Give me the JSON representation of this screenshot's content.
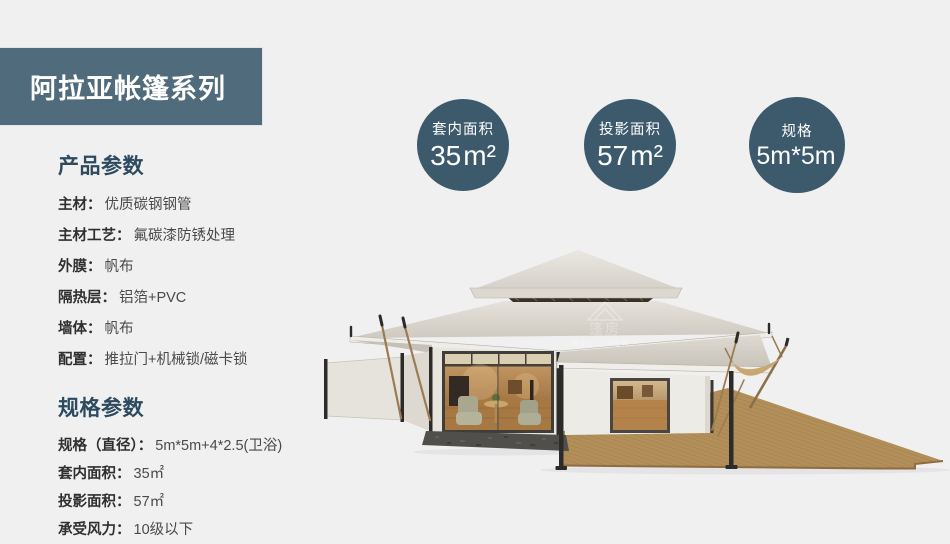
{
  "banner": {
    "title": "阿拉亚帐篷系列"
  },
  "badges": [
    {
      "label": "套内面积",
      "value": "35",
      "unit": "m²"
    },
    {
      "label": "投影面积",
      "value": "57",
      "unit": "m²"
    },
    {
      "label": "规格",
      "value": "5m*5m",
      "unit": ""
    }
  ],
  "sections": [
    {
      "title": "产品参数",
      "rows": [
        {
          "label": "主材：",
          "value": "优质碳钢钢管"
        },
        {
          "label": "主材工艺：",
          "value": "氟碳漆防锈处理"
        },
        {
          "label": "外膜：",
          "value": "帆布"
        },
        {
          "label": "隔热层：",
          "value": "铝箔+PVC"
        },
        {
          "label": "墙体：",
          "value": "帆布"
        },
        {
          "label": "配置：",
          "value": "推拉门+机械锁/磁卡锁"
        }
      ]
    },
    {
      "title": "规格参数",
      "rows": [
        {
          "label": "规格（直径）：",
          "value": "5m*5m+4*2.5(卫浴)"
        },
        {
          "label": "套内面积：",
          "value": "35㎡"
        },
        {
          "label": "投影面积：",
          "value": "57㎡"
        },
        {
          "label": "承受风力：",
          "value": "10级以下"
        }
      ]
    }
  ],
  "illustration": {
    "description": "luxury pagoda tent with glass wall, side awning and wooden deck",
    "watermark_cn": "篷房",
    "watermark_en": "WELL TENT"
  },
  "colors": {
    "background": "#f0f0f1",
    "banner": "#506c7c",
    "badge": "#3d5a6d",
    "section_title": "#2d4a5f",
    "roof_canvas": "#d9d5cc",
    "deck_wood": "#b28e58"
  }
}
